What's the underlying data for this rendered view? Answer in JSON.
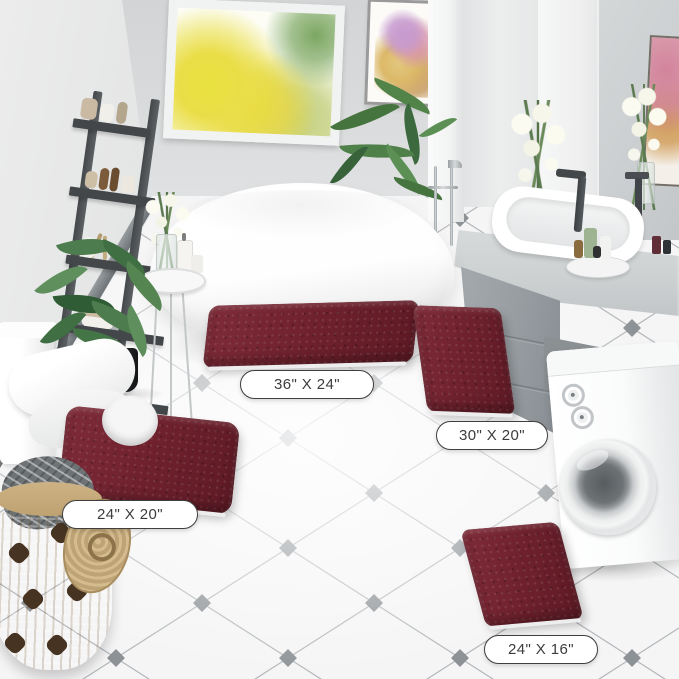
{
  "scene": {
    "type": "bathroom product photo",
    "fixtures": [
      "window-with-yellow-trees",
      "wall-art",
      "ladder-shelf",
      "potted-plant",
      "toilet",
      "freestanding-bathtub",
      "tub-faucet",
      "side-table",
      "palm-plant",
      "vanity-mirror",
      "vanity-sink",
      "vanity-cabinet",
      "washing-machine",
      "laundry-basket",
      "tiled-floor"
    ]
  },
  "rugs": [
    {
      "name": "rug-36x24",
      "size_label": "36\" X 24\""
    },
    {
      "name": "rug-30x20",
      "size_label": "30\" X 20\""
    },
    {
      "name": "rug-24x20-contour",
      "size_label": "24\" X 20\""
    },
    {
      "name": "rug-24x16",
      "size_label": "24\" X 16\""
    }
  ],
  "colors": {
    "rug_burgundy": "#70222e",
    "wall_gray": "#d8dadb",
    "floor_white": "#f5f5f6",
    "tile_accent_gray": "#8d9296",
    "cabinet_gray": "#969ca0",
    "ladder_gray": "#4f5356",
    "basket_tan": "#c8ae7f",
    "label_border": "#3f3f3f",
    "label_text": "#3c3c3c"
  }
}
